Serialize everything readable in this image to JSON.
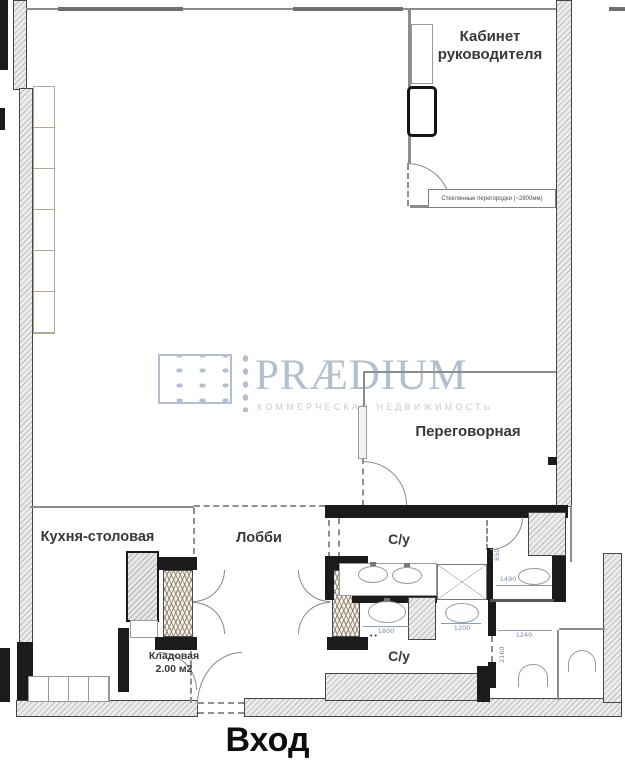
{
  "brand": {
    "name": "PRÆDIUM",
    "tagline": "КОММЕРЧЕСКАЯ НЕДВИЖИМОСТЬ"
  },
  "rooms": {
    "office": {
      "line1": "Кабинет",
      "line2": "руководителя"
    },
    "meeting": {
      "label": "Переговорная"
    },
    "kitchen": {
      "label": "Кухня-столовая"
    },
    "lobby": {
      "label": "Лобби"
    },
    "wc_upper": {
      "label": "С/у"
    },
    "wc_lower": {
      "label": "С/у"
    },
    "storage": {
      "line1": "Кладовая",
      "line2": "2.00 м2"
    },
    "entrance": {
      "label": "Вход"
    }
  },
  "notes": {
    "glass_partitions": "Стеклянные перегородки (~2800мм)"
  },
  "dimensions": {
    "d1800": "1800",
    "d1200": "1200",
    "d1240": "1240",
    "d1490": "1490",
    "d2160": "2160",
    "d850": "850"
  },
  "colors": {
    "wall_black": "#1b1b1b",
    "wall_hatch_line": "#bdbdbd",
    "dimension_text": "#7c8db0",
    "label_text": "#383838",
    "watermark": "#b3bfd0"
  }
}
